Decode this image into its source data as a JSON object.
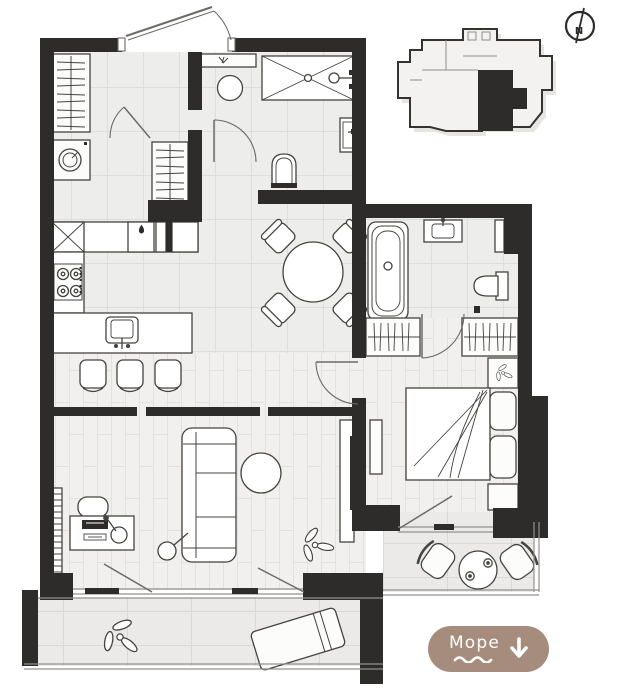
{
  "scene": {
    "background": "#ffffff",
    "wall_color": "#2d2c2a",
    "tile_floor_color": "#ededeb",
    "plank_floor_color": "#f2f0ee",
    "balcony_floor_color": "#eceae8",
    "furniture_stroke": "#44433f"
  },
  "compass": {
    "label": "N"
  },
  "mini_plan": {
    "highlight_color": "#2d2c2a",
    "outline_color": "#34332f"
  },
  "cta": {
    "label": "Море",
    "background": "#a58c7d",
    "text_color": "#ffffff"
  }
}
